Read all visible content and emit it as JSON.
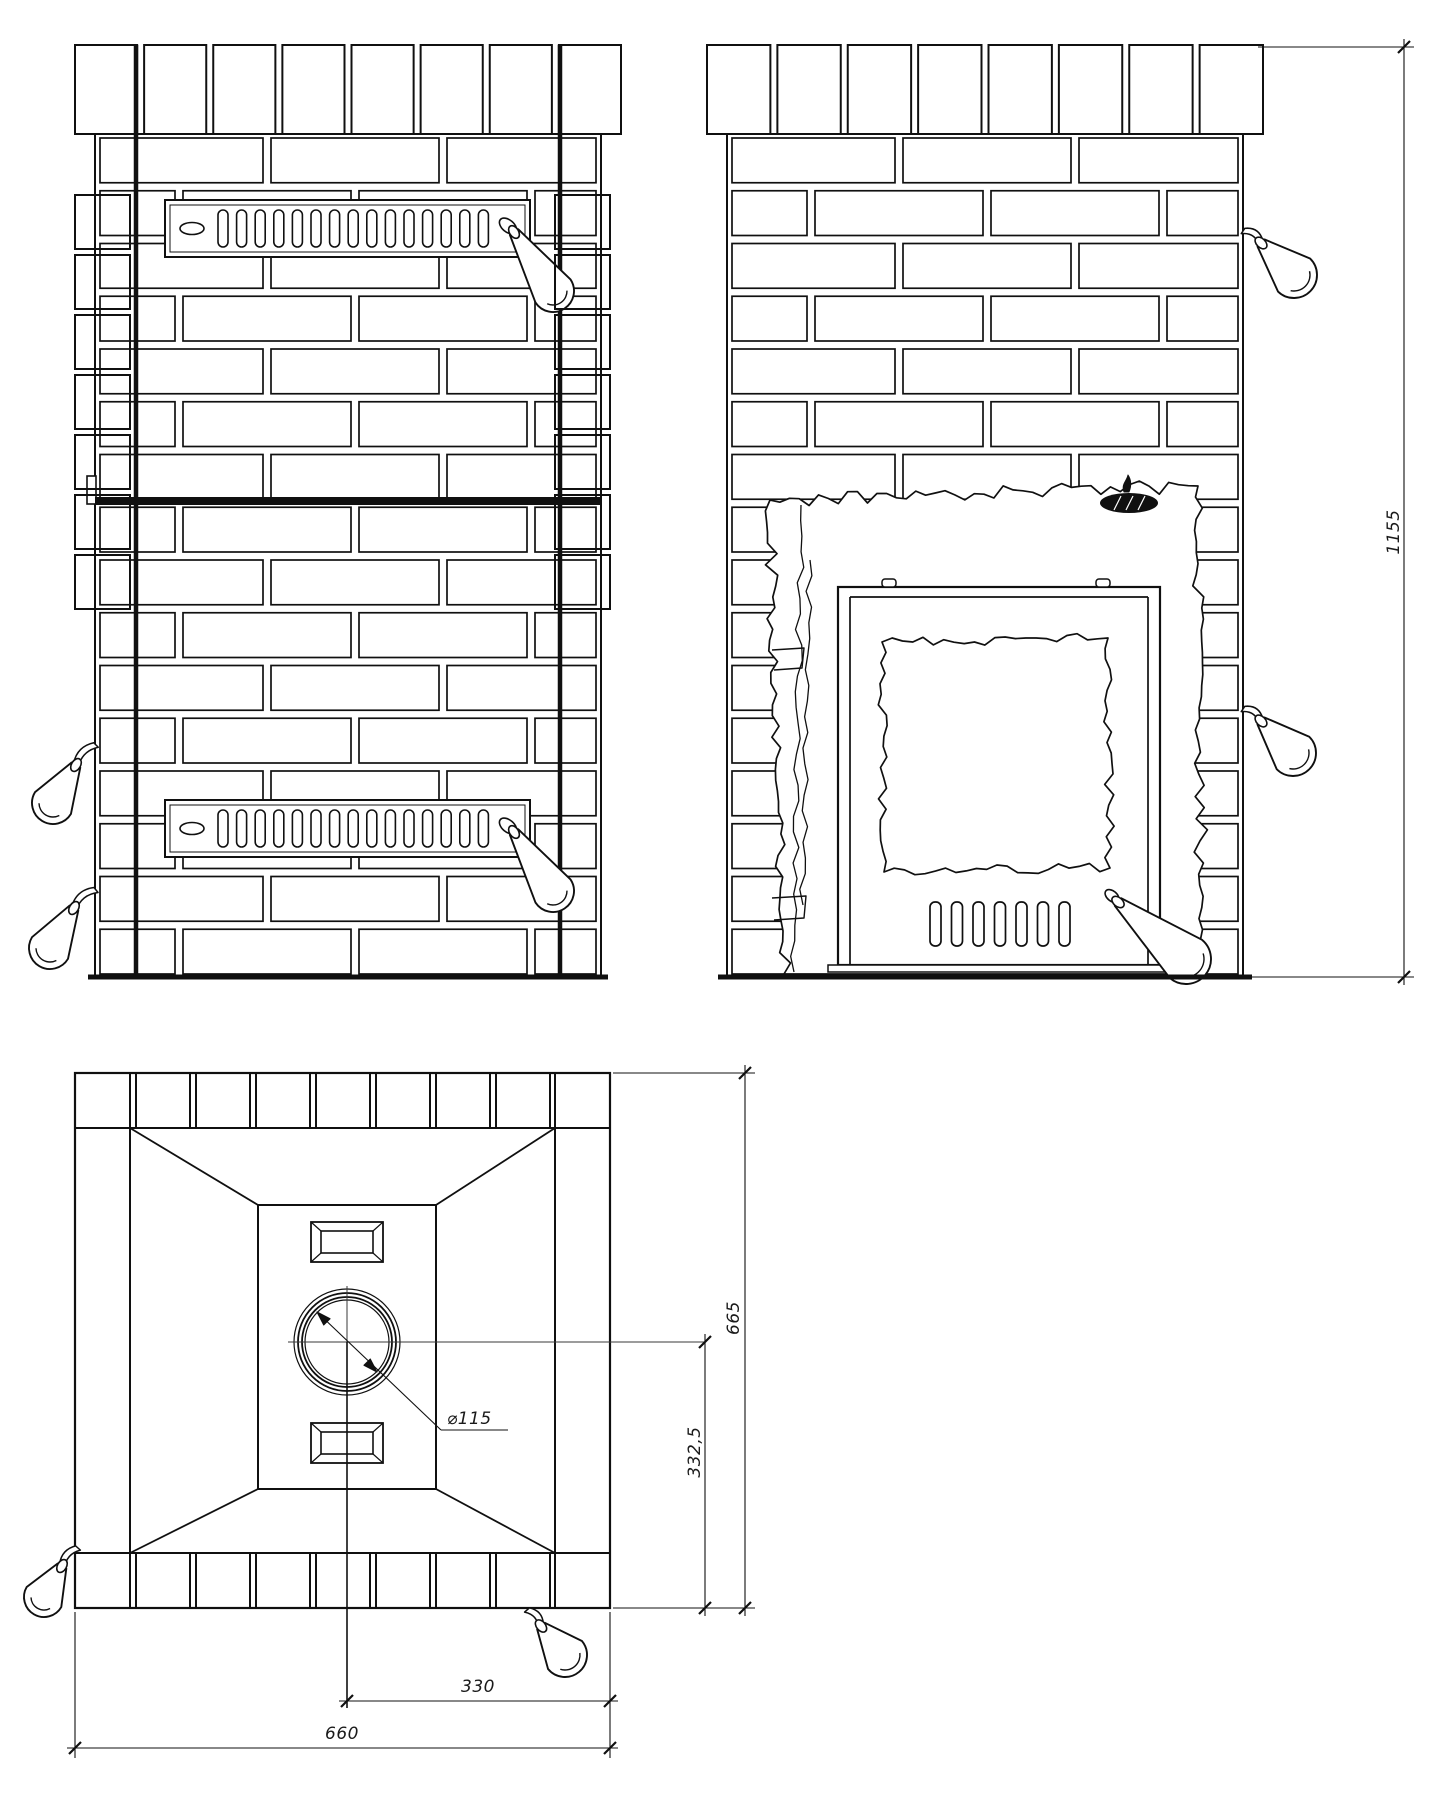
{
  "drawing": {
    "type": "technical-drawing",
    "subject": "brick-clad sauna stove, orthographic views",
    "views": [
      {
        "id": "front-elevation"
      },
      {
        "id": "cutaway-elevation-with-firebox-door"
      },
      {
        "id": "top-plan"
      }
    ]
  },
  "dimensions": {
    "height_overall": "1155",
    "depth_overall": "665",
    "flue_center_offset": "332,5",
    "width_overall": "660",
    "flue_center_half_width": "330",
    "flue_diameter": "⌀115"
  },
  "features": {
    "upper_grille_slots": 15,
    "lower_grille_slots": 15,
    "door_vent_slots": 7,
    "crown_bricks_per_view": 8,
    "brick_courses": 16,
    "icons": [
      "brand-logo-icon",
      "flame-icon",
      "valve-handle-icon"
    ]
  },
  "colors": {
    "ink": "#101010",
    "paper": "#ffffff",
    "dim_ink": "#1a1a1a"
  }
}
